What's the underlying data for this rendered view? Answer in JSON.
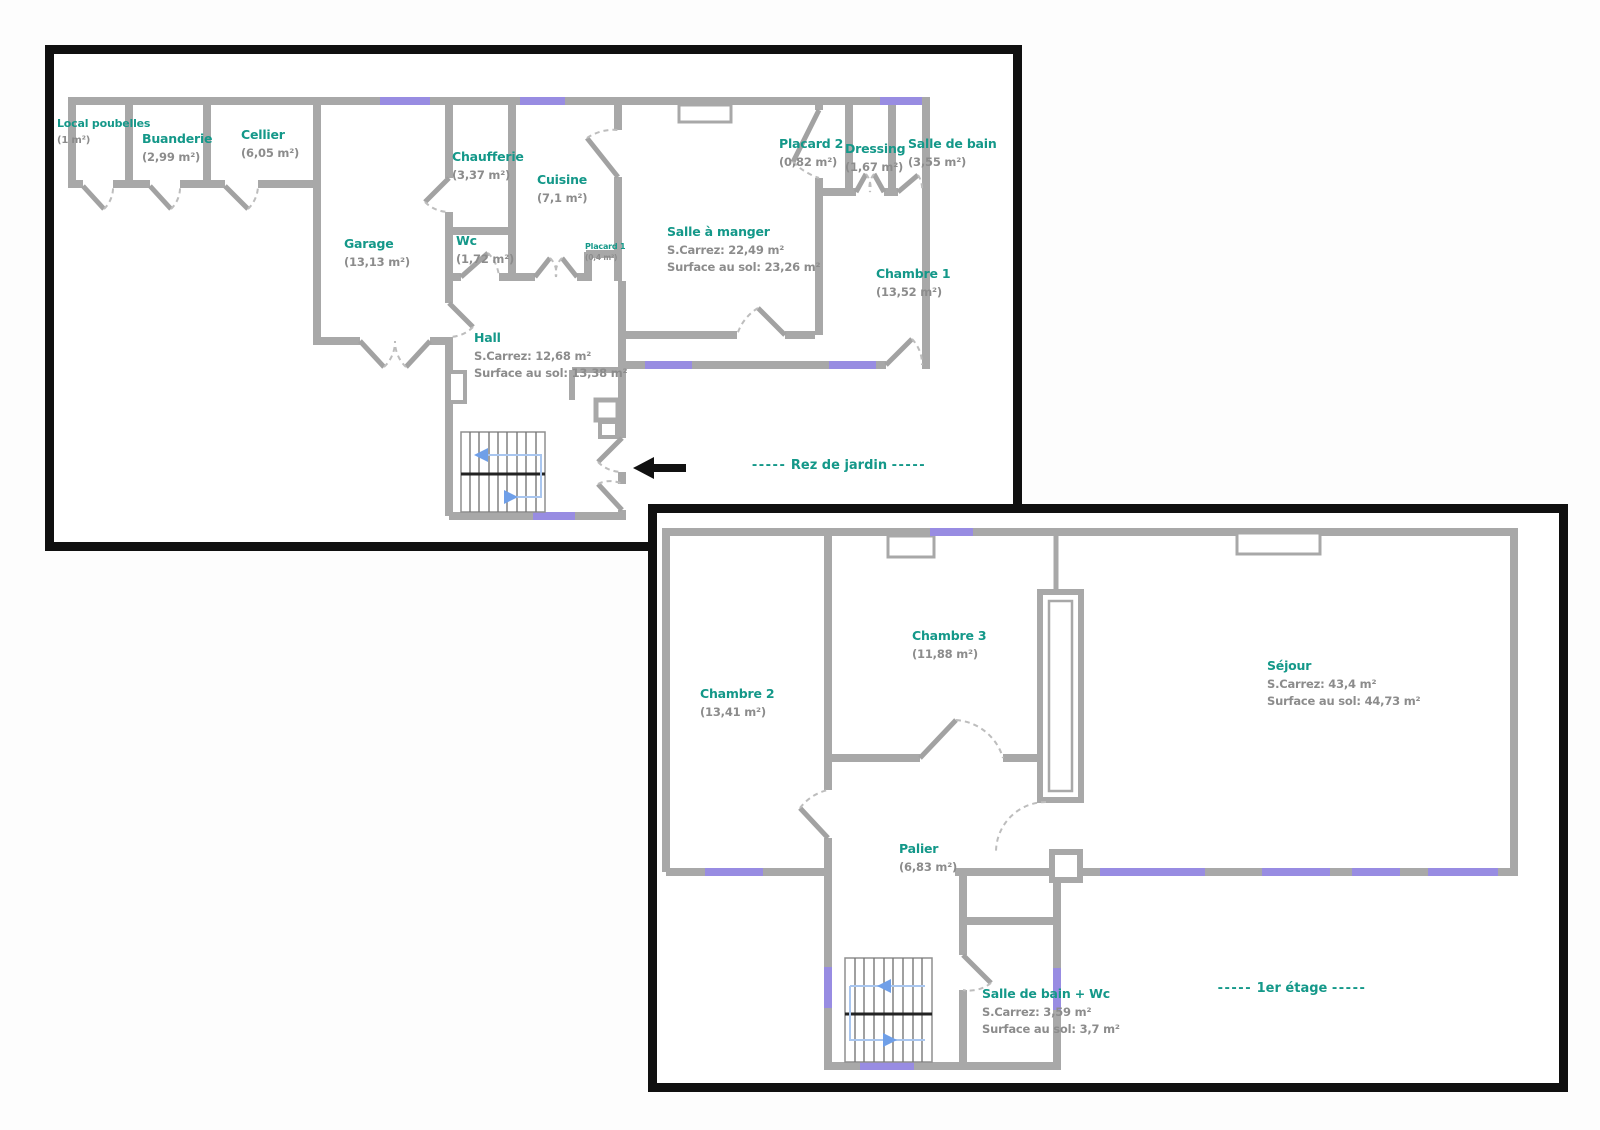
{
  "document_type": "floor-plan",
  "colors": {
    "label_teal": "#149889",
    "area_gray": "#8c8c8c",
    "wall_gray": "#a8a8a8",
    "frame_black": "#101010",
    "window_lavender": "#988ce2",
    "stair_path_blue": "#a9c6ef",
    "stair_arrow_blue": "#6f9fe8",
    "background": "#ffffff"
  },
  "icons": {
    "entrance_arrow": "left-arrow-icon"
  },
  "plans": [
    {
      "id": "rez-de-jardin",
      "caption": "Rez de jardin",
      "caption_dashes_left": "-----",
      "caption_dashes_right": "-----",
      "rooms": [
        {
          "name": "Local poubelles",
          "area": "(1 m²)"
        },
        {
          "name": "Buanderie",
          "area": "(2,99 m²)"
        },
        {
          "name": "Cellier",
          "area": "(6,05 m²)"
        },
        {
          "name": "Chaufferie",
          "area": "(3,37 m²)"
        },
        {
          "name": "Cuisine",
          "area": "(7,1 m²)"
        },
        {
          "name": "Garage",
          "area": "(13,13 m²)"
        },
        {
          "name": "Wc",
          "area": "(1,72 m²)"
        },
        {
          "name": "Placard 1",
          "area": "(0,4 m²)"
        },
        {
          "name": "Salle à manger",
          "area_lines": [
            "S.Carrez: 22,49 m²",
            "Surface au sol: 23,26 m²"
          ]
        },
        {
          "name": "Placard 2",
          "area": "(0,82 m²)"
        },
        {
          "name": "Dressing",
          "area": "(1,67 m²)"
        },
        {
          "name": "Salle de bain",
          "area": "(3,55 m²)"
        },
        {
          "name": "Chambre 1",
          "area": "(13,52 m²)"
        },
        {
          "name": "Hall",
          "area_lines": [
            "S.Carrez: 12,68 m²",
            "Surface au sol: 13,38 m²"
          ]
        }
      ]
    },
    {
      "id": "1er-etage",
      "caption": "1er étage",
      "caption_dashes_left": "-----",
      "caption_dashes_right": "-----",
      "rooms": [
        {
          "name": "Chambre 2",
          "area": "(13,41 m²)"
        },
        {
          "name": "Chambre 3",
          "area": "(11,88 m²)"
        },
        {
          "name": "Séjour",
          "area_lines": [
            "S.Carrez: 43,4 m²",
            "Surface au sol: 44,73 m²"
          ]
        },
        {
          "name": "Palier",
          "area": "(6,83 m²)"
        },
        {
          "name": "Salle de bain + Wc",
          "area_lines": [
            "S.Carrez: 3,59 m²",
            "Surface au sol: 3,7 m²"
          ]
        }
      ]
    }
  ]
}
